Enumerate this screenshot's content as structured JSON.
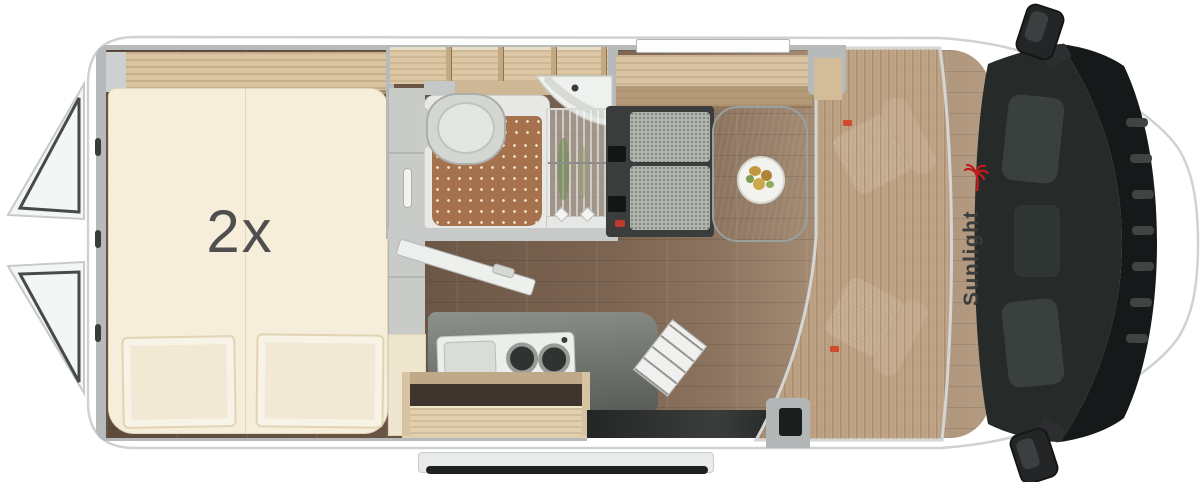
{
  "floorplan": {
    "bed_capacity_label": "2x",
    "brand": "Sunlight",
    "colors": {
      "body_white": "#ffffff",
      "outline_gray": "#cfd2d3",
      "wall_gray": "#b7babb",
      "floor_wood_dark": "#5e4b3c",
      "floor_wood_light": "#b39a80",
      "furniture_wood": "#d9c4a2",
      "mattress_cream": "#f6eedb",
      "shower_mat_brown": "#a6724d",
      "counter_gray": "#6f7370",
      "bench_dark": "#3a3d3b",
      "cushion_speckle": "#b2b4ae",
      "table_gray": "#7c8280",
      "windshield_dark": "#262b29",
      "accent_red": "#c41a1c",
      "label_gray": "#4f4f4f"
    }
  }
}
